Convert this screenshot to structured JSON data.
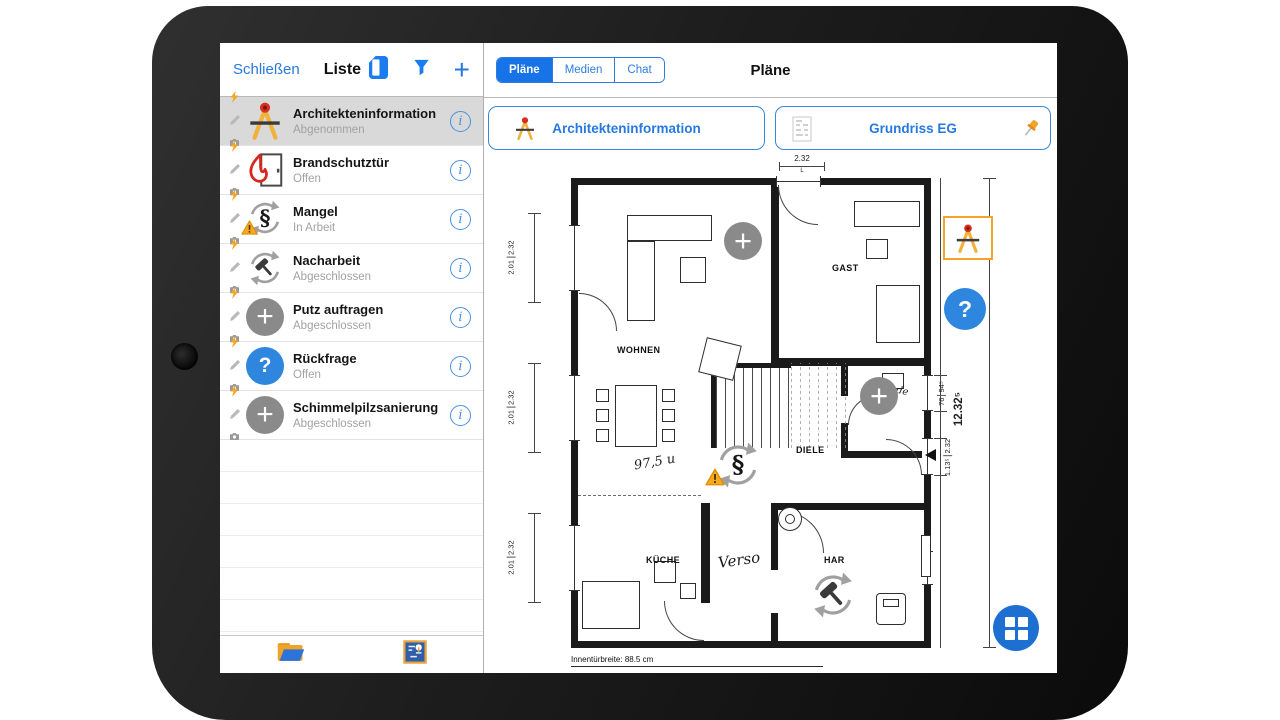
{
  "left_panel": {
    "close_label": "Schließen",
    "title": "Liste",
    "header_icons": [
      "report-icon",
      "filter-icon",
      "add-icon"
    ],
    "items": [
      {
        "title": "Architekteninformation",
        "status": "Abgenommen",
        "icon": "compass-icon",
        "selected": true
      },
      {
        "title": "Brandschutztür",
        "status": "Offen",
        "icon": "fire-door-icon",
        "selected": false
      },
      {
        "title": "Mangel",
        "status": "In Arbeit",
        "icon": "paragraph-warning-icon",
        "selected": false
      },
      {
        "title": "Nacharbeit",
        "status": "Abgeschlossen",
        "icon": "hammer-cycle-icon",
        "selected": false
      },
      {
        "title": "Putz auftragen",
        "status": "Abgeschlossen",
        "icon": "plus-circle-icon",
        "selected": false
      },
      {
        "title": "Rückfrage",
        "status": "Offen",
        "icon": "question-circle-icon",
        "selected": false
      },
      {
        "title": "Schimmelpilzsanierung",
        "status": "Abgeschlossen",
        "icon": "plus-circle-icon",
        "selected": false
      }
    ],
    "row_mini_icons": [
      "flash-icon",
      "pencil-icon",
      "camera-icon"
    ],
    "footer_icons": [
      "folder-icon",
      "plan-thumbnail-icon"
    ]
  },
  "right_panel": {
    "title": "Pläne",
    "tabs": [
      {
        "label": "Pläne",
        "selected": true
      },
      {
        "label": "Medien",
        "selected": false
      },
      {
        "label": "Chat",
        "selected": false
      }
    ],
    "plan_buttons": [
      {
        "label": "Architekteninformation",
        "icon": "compass-icon"
      },
      {
        "label": "Grundriss EG",
        "icon": "plan-thumbnail-icon",
        "pin": "pin-icon"
      }
    ]
  },
  "floor_plan": {
    "rooms": {
      "wohnen": "WOHNEN",
      "gast": "GAST",
      "diele": "DIELE",
      "kueche": "KÜCHE",
      "har": "HAR"
    },
    "dimensions": {
      "top_entrance": "2.32",
      "top_entrance_sub": "L",
      "left_window_w": "2.01",
      "left_window_h": "2.32",
      "right_window_w": "76",
      "right_window_h": "94⁵",
      "right_door_w": "1.13⁵",
      "right_door_h": "2.32",
      "right_total": "12.32⁵",
      "footer_note": "Innentürbreite: 88.5 cm"
    },
    "handwritten": {
      "stair_note": "97,5 u",
      "corridor_note": "Verso",
      "wc_note": "de"
    },
    "markers": [
      "plus-marker",
      "plus-marker",
      "paragraph-warning-marker",
      "hammer-cycle-marker",
      "compass-marker-selected",
      "question-marker"
    ]
  },
  "colors": {
    "accent_blue": "#1b7cf0",
    "marker_gray": "#8a8a8a",
    "warning_orange": "#f5a623",
    "flame_red": "#d6281e",
    "selected_row_bg": "#d9d9d9"
  }
}
